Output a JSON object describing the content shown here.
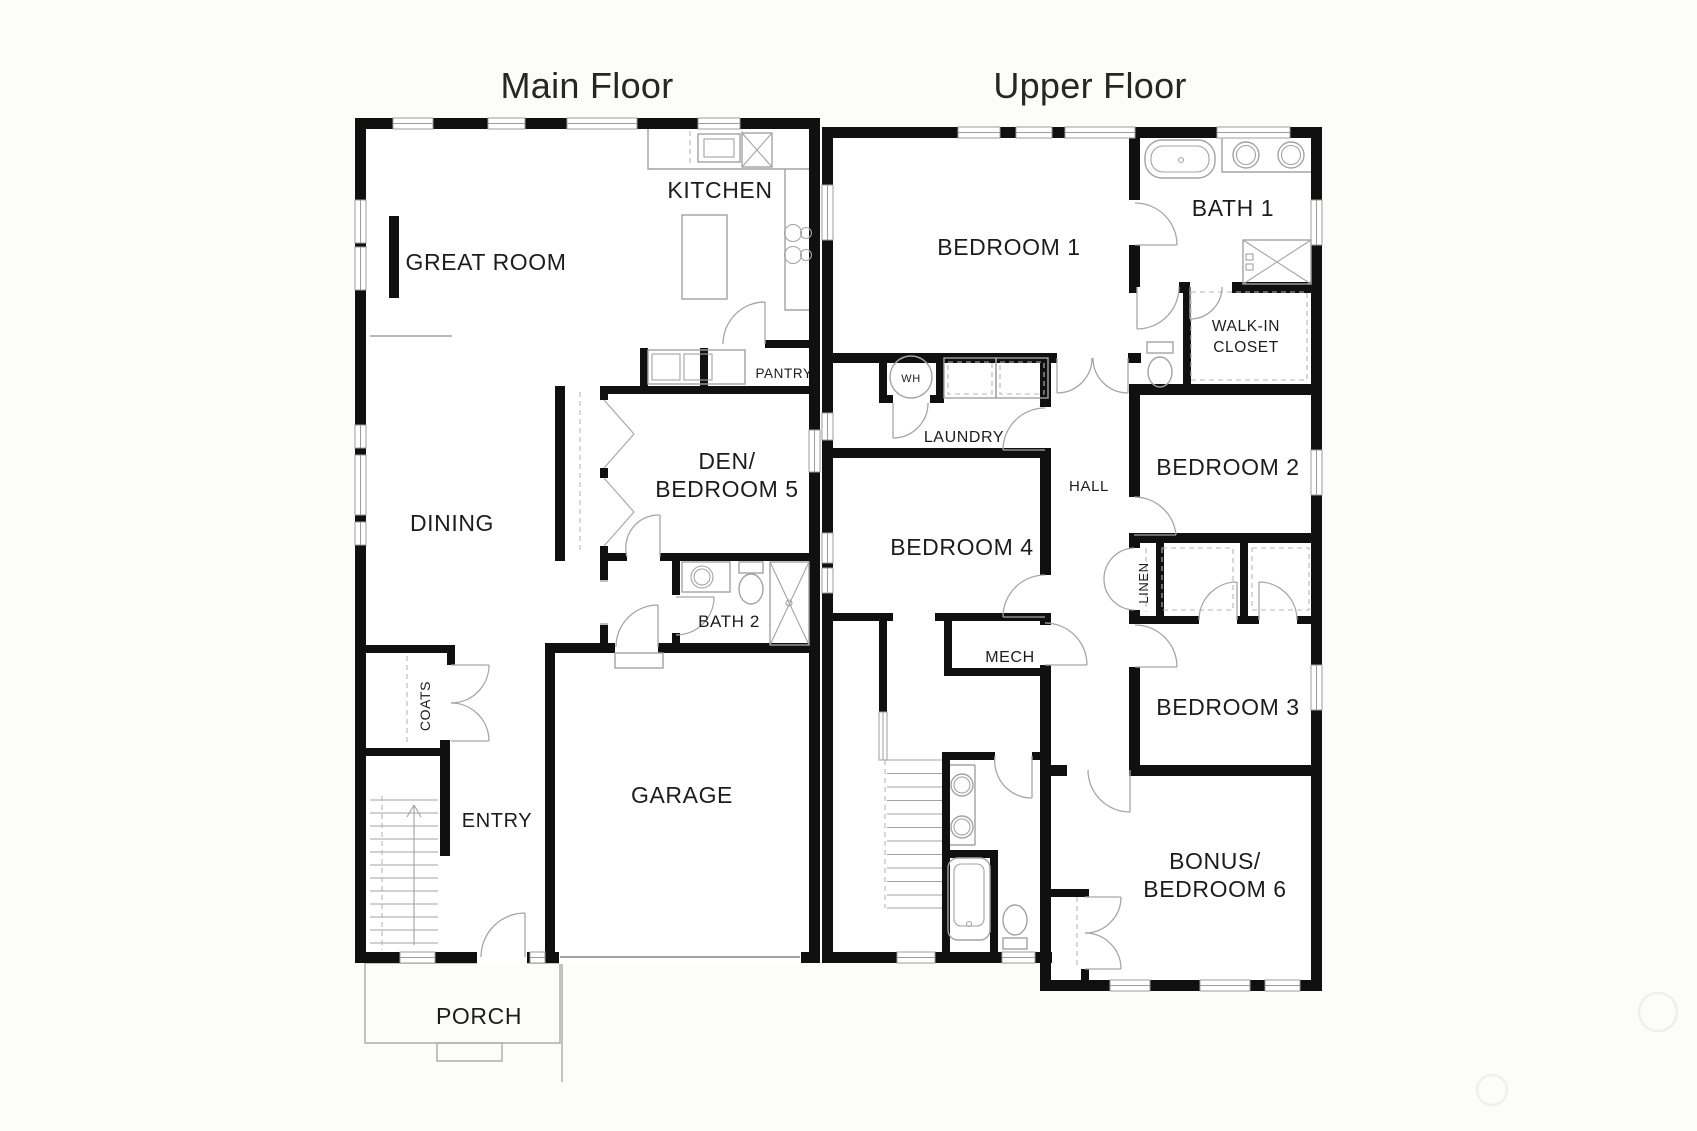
{
  "document": {
    "type": "floor-plan-drawing"
  },
  "colors": {
    "bg": "#fcfcfb",
    "wall": "#101010",
    "label": "#1d1d1d",
    "fixture": "#a3a3a3",
    "door": "#a6a6a6",
    "window": "#9c9c9c",
    "dash": "#b6b6b6",
    "porch": "#b3b3b3",
    "watermark": "#f0efeb"
  },
  "floors": [
    {
      "title": "Main Floor",
      "rooms": {
        "kitchen": "KITCHEN",
        "great_room": "GREAT ROOM",
        "pantry": "PANTRY",
        "den": {
          "line1": "DEN/",
          "line2": "BEDROOM 5"
        },
        "dining": "DINING",
        "bath2": "BATH 2",
        "coats": "COATS",
        "entry": "ENTRY",
        "garage": "GARAGE",
        "porch": "PORCH"
      }
    },
    {
      "title": "Upper Floor",
      "rooms": {
        "bedroom1": "BEDROOM 1",
        "bath1": "BATH 1",
        "walkin": {
          "line1": "WALK-IN",
          "line2": "CLOSET"
        },
        "wh": "WH",
        "laundry": "LAUNDRY",
        "hall": "HALL",
        "bedroom2": "BEDROOM 2",
        "bedroom4": "BEDROOM 4",
        "linen": "LINEN",
        "mech": "MECH",
        "bedroom3": "BEDROOM 3",
        "bonus": {
          "line1": "BONUS/",
          "line2": "BEDROOM 6"
        }
      }
    }
  ]
}
